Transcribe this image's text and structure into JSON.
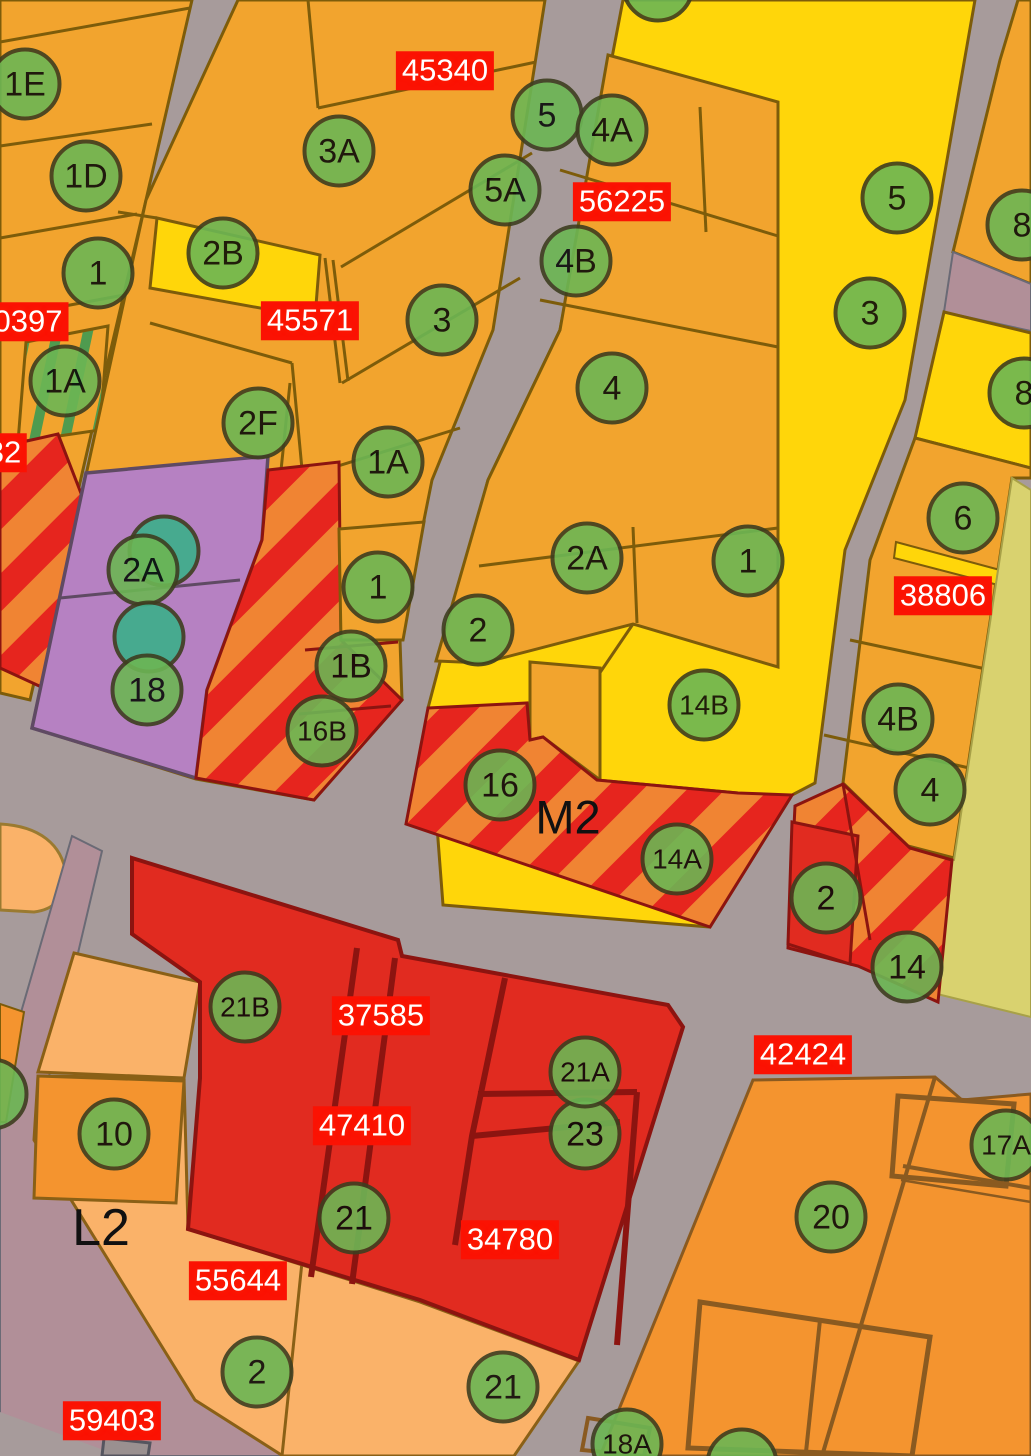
{
  "map": {
    "zone_labels": [
      {
        "text": "M2",
        "x": 568,
        "y": 817,
        "size": 47
      },
      {
        "text": "L2",
        "x": 101,
        "y": 1228,
        "size": 52
      }
    ],
    "parcel_id_labels": [
      {
        "text": "45340",
        "x": 445,
        "y": 71
      },
      {
        "text": "56225",
        "x": 622,
        "y": 202
      },
      {
        "text": "45571",
        "x": 310,
        "y": 321
      },
      {
        "text": "0397",
        "x": 28,
        "y": 322
      },
      {
        "text": "32",
        "x": 4,
        "y": 453
      },
      {
        "text": "38806",
        "x": 943,
        "y": 596
      },
      {
        "text": "37585",
        "x": 381,
        "y": 1016
      },
      {
        "text": "47410",
        "x": 362,
        "y": 1126
      },
      {
        "text": "34780",
        "x": 510,
        "y": 1240
      },
      {
        "text": "42424",
        "x": 803,
        "y": 1055
      },
      {
        "text": "55644",
        "x": 238,
        "y": 1281
      },
      {
        "text": "59403",
        "x": 112,
        "y": 1421
      }
    ],
    "markers": [
      {
        "text": "1E",
        "x": 25,
        "y": 84
      },
      {
        "text": "1D",
        "x": 86,
        "y": 176
      },
      {
        "text": "1",
        "x": 98,
        "y": 273
      },
      {
        "text": "1A",
        "x": 65,
        "y": 381
      },
      {
        "text": "",
        "x": 658,
        "y": -14
      },
      {
        "text": "5",
        "x": 547,
        "y": 115
      },
      {
        "text": "4A",
        "x": 612,
        "y": 130
      },
      {
        "text": "5A",
        "x": 505,
        "y": 190
      },
      {
        "text": "4B",
        "x": 576,
        "y": 261
      },
      {
        "text": "3A",
        "x": 339,
        "y": 151
      },
      {
        "text": "2B",
        "x": 223,
        "y": 253
      },
      {
        "text": "3",
        "x": 442,
        "y": 320
      },
      {
        "text": "4",
        "x": 612,
        "y": 388
      },
      {
        "text": "5",
        "x": 897,
        "y": 198
      },
      {
        "text": "3",
        "x": 870,
        "y": 313
      },
      {
        "text": "8",
        "x": 1022,
        "y": 225
      },
      {
        "text": "8",
        "x": 1024,
        "y": 393
      },
      {
        "text": "6",
        "x": 963,
        "y": 518
      },
      {
        "text": "2F",
        "x": 258,
        "y": 423
      },
      {
        "text": "1A",
        "x": 388,
        "y": 462
      },
      {
        "text": "",
        "x": 164,
        "y": 551,
        "variant": "teal"
      },
      {
        "text": "2A",
        "x": 143,
        "y": 570
      },
      {
        "text": "",
        "x": 149,
        "y": 637,
        "variant": "teal"
      },
      {
        "text": "18",
        "x": 147,
        "y": 690
      },
      {
        "text": "1",
        "x": 378,
        "y": 587
      },
      {
        "text": "1B",
        "x": 351,
        "y": 666
      },
      {
        "text": "16B",
        "x": 322,
        "y": 731
      },
      {
        "text": "2A",
        "x": 587,
        "y": 558
      },
      {
        "text": "1",
        "x": 748,
        "y": 561
      },
      {
        "text": "2",
        "x": 478,
        "y": 630
      },
      {
        "text": "14B",
        "x": 704,
        "y": 705
      },
      {
        "text": "16",
        "x": 500,
        "y": 785
      },
      {
        "text": "14A",
        "x": 677,
        "y": 859
      },
      {
        "text": "4B",
        "x": 898,
        "y": 719
      },
      {
        "text": "4",
        "x": 930,
        "y": 790
      },
      {
        "text": "2",
        "x": 826,
        "y": 898
      },
      {
        "text": "14",
        "x": 907,
        "y": 967
      },
      {
        "text": "21B",
        "x": 245,
        "y": 1007
      },
      {
        "text": "10",
        "x": 114,
        "y": 1134
      },
      {
        "text": "3",
        "x": -8,
        "y": 1094
      },
      {
        "text": "21",
        "x": 354,
        "y": 1218
      },
      {
        "text": "23",
        "x": 585,
        "y": 1134
      },
      {
        "text": "21A",
        "x": 585,
        "y": 1072
      },
      {
        "text": "21",
        "x": 503,
        "y": 1387
      },
      {
        "text": "2",
        "x": 257,
        "y": 1372
      },
      {
        "text": "18A",
        "x": 627,
        "y": 1444
      },
      {
        "text": "",
        "x": 742,
        "y": 1464
      },
      {
        "text": "20",
        "x": 831,
        "y": 1217
      },
      {
        "text": "17A",
        "x": 1006,
        "y": 1145
      }
    ],
    "colors": {
      "road": "#A79B9B",
      "road_minor": "#B18F98",
      "parcel_orange": "#F2A42E",
      "parcel_orange_light": "#FAB269",
      "parcel_orange_deep": "#F4942F",
      "parcel_yellow": "#FFD60A",
      "parcel_purple": "#B681C2",
      "parcel_red": "#E12B20",
      "stripe_red": "#E6251E",
      "stripe_orange": "#F08433",
      "parcel_khaki": "#D9D26F",
      "marker_green": "#6CB654",
      "marker_teal": "#3CAF8A",
      "marker_border": "#3E3E20",
      "label_bg": "#FB1203",
      "label_text": "#FFFFFF",
      "zone_text": "#111111"
    }
  }
}
